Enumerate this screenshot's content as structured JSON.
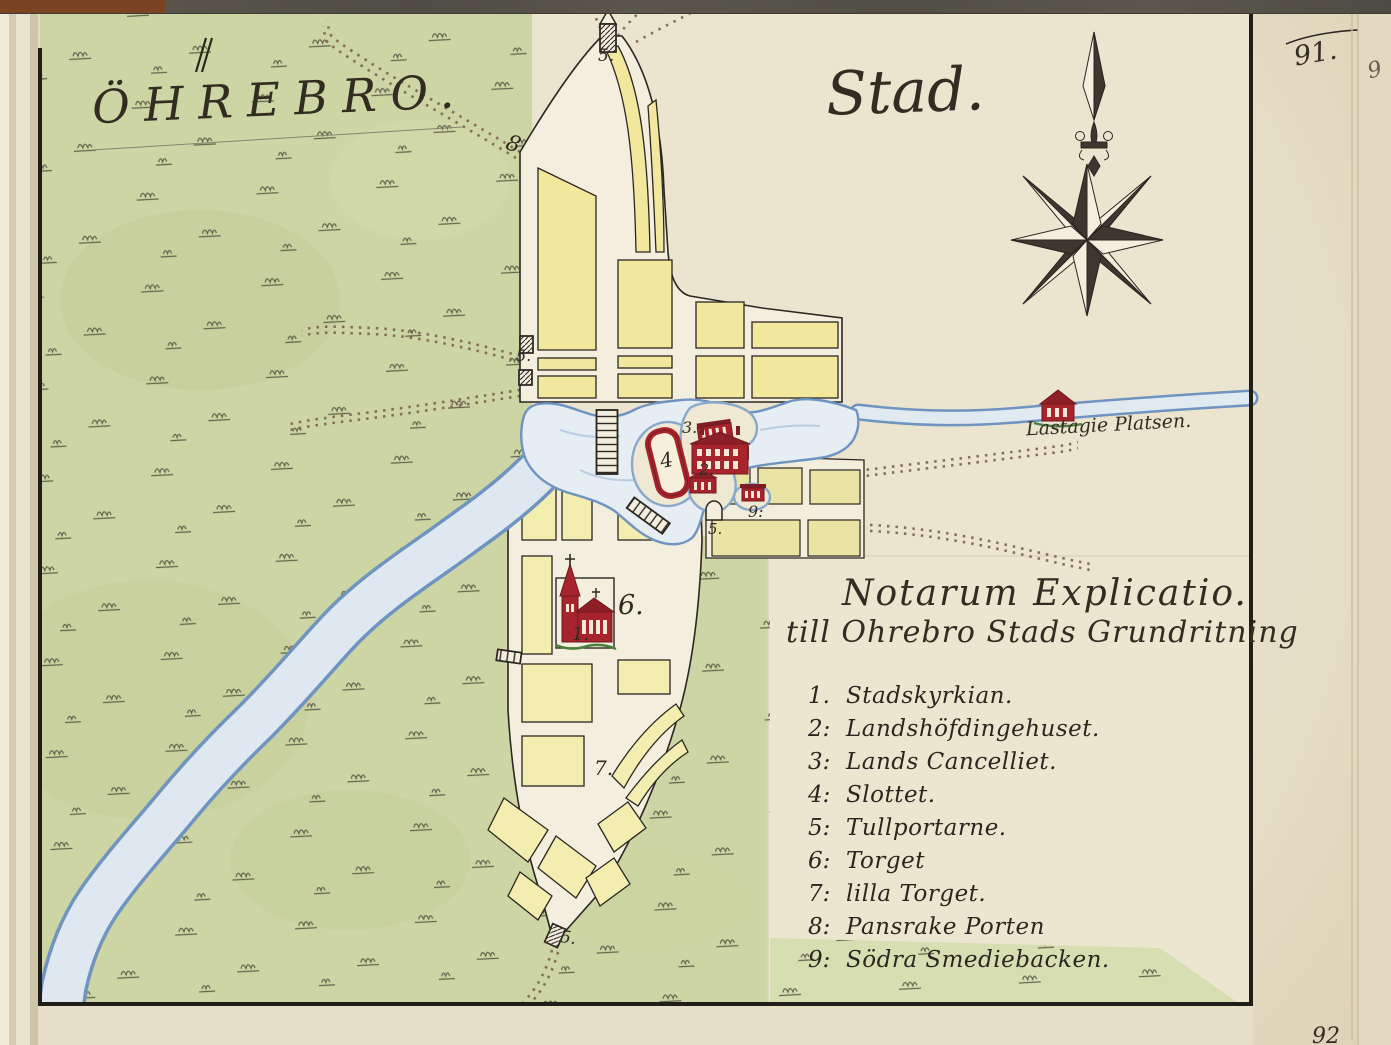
{
  "page": {
    "number": "91.",
    "next_number": "92",
    "corner_digit": "9"
  },
  "titles": {
    "left": "ÖHREBRO.",
    "right": "Stad."
  },
  "legend": {
    "title": "Notarum Explicatio.",
    "subtitle": "till Ohrebro Stads Grundritning",
    "items": [
      {
        "num": "1.",
        "label": "Stadskyrkian."
      },
      {
        "num": "2:",
        "label": "Landshöfdingehuset."
      },
      {
        "num": "3:",
        "label": "Lands Cancelliet."
      },
      {
        "num": "4:",
        "label": "Slottet."
      },
      {
        "num": "5:",
        "label": "Tullportarne."
      },
      {
        "num": "6:",
        "label": "Torget"
      },
      {
        "num": "7:",
        "label": "lilla Torget."
      },
      {
        "num": "8:",
        "label": "Pansrake Porten"
      },
      {
        "num": "9:",
        "label": "Södra Smediebacken."
      }
    ]
  },
  "map_labels": {
    "lastagie": "Lastagie Platsen.",
    "north_gate": "5.",
    "pansrake_gate": "8",
    "west_gate": "5.",
    "east_gate": "5.",
    "south_gate": "5.",
    "castle": "4",
    "lands_cancelliet": "3.",
    "landshofdingehuset": "2.",
    "stadskyrkian": "1.",
    "torget": "6.",
    "lilla_torget": "7.",
    "smediebacken_street": "9:"
  },
  "colors": {
    "field_green": "#ccd5a3",
    "town_yellow": "#f1e89d",
    "river_blue": "#e6edf3",
    "building_red": "#a8242c",
    "ink": "#2b2722",
    "paper": "#ebe5cf"
  }
}
